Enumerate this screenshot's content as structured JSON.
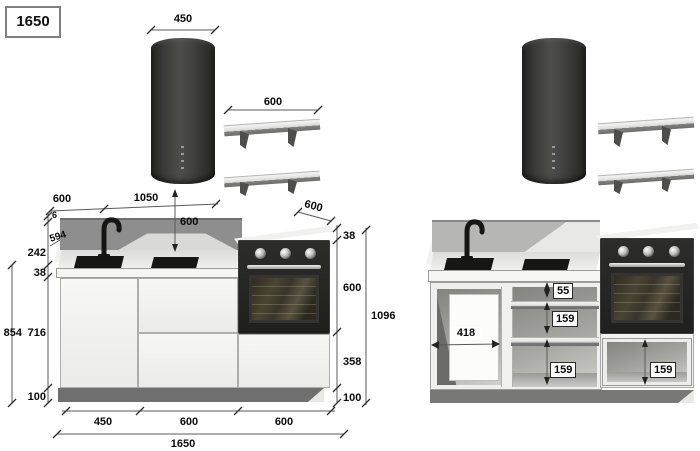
{
  "legend": {
    "total_width": "1650"
  },
  "colors": {
    "appliance_black": "#232321",
    "splash_left": "#8e8e8e",
    "splash_right": "#b6b6b4",
    "cabinet_white": "#f3f3f1",
    "plinth_gray": "#6f6f6f",
    "dimension_text": "#0a0a0a"
  },
  "left_view": {
    "hood_width": "450",
    "shelf_width": "600",
    "wall_seg_a": "600",
    "wall_seg_b": "1050",
    "hood_clearance": "600",
    "counter_depth": "600",
    "splash_trim": "6",
    "splash_length": "594",
    "splash_height": "242",
    "counter_thickness": "38",
    "base_total_height": "854",
    "carcass_height": "716",
    "plinth_height": "100",
    "tower_counter_thickness": "38",
    "tower_oven_height": "600",
    "tower_drawer_height": "358",
    "tower_plinth_height": "100",
    "tower_total_height": "1096",
    "bay_sink_width": "450",
    "bay_drawer_width": "600",
    "bay_oven_width": "600",
    "run_total_width": "1650"
  },
  "right_view": {
    "opening_width": "418",
    "top_drawer_height": "55",
    "mid_drawer_height": "159",
    "low_drawer_height": "159",
    "oven_drawer_height": "159"
  }
}
